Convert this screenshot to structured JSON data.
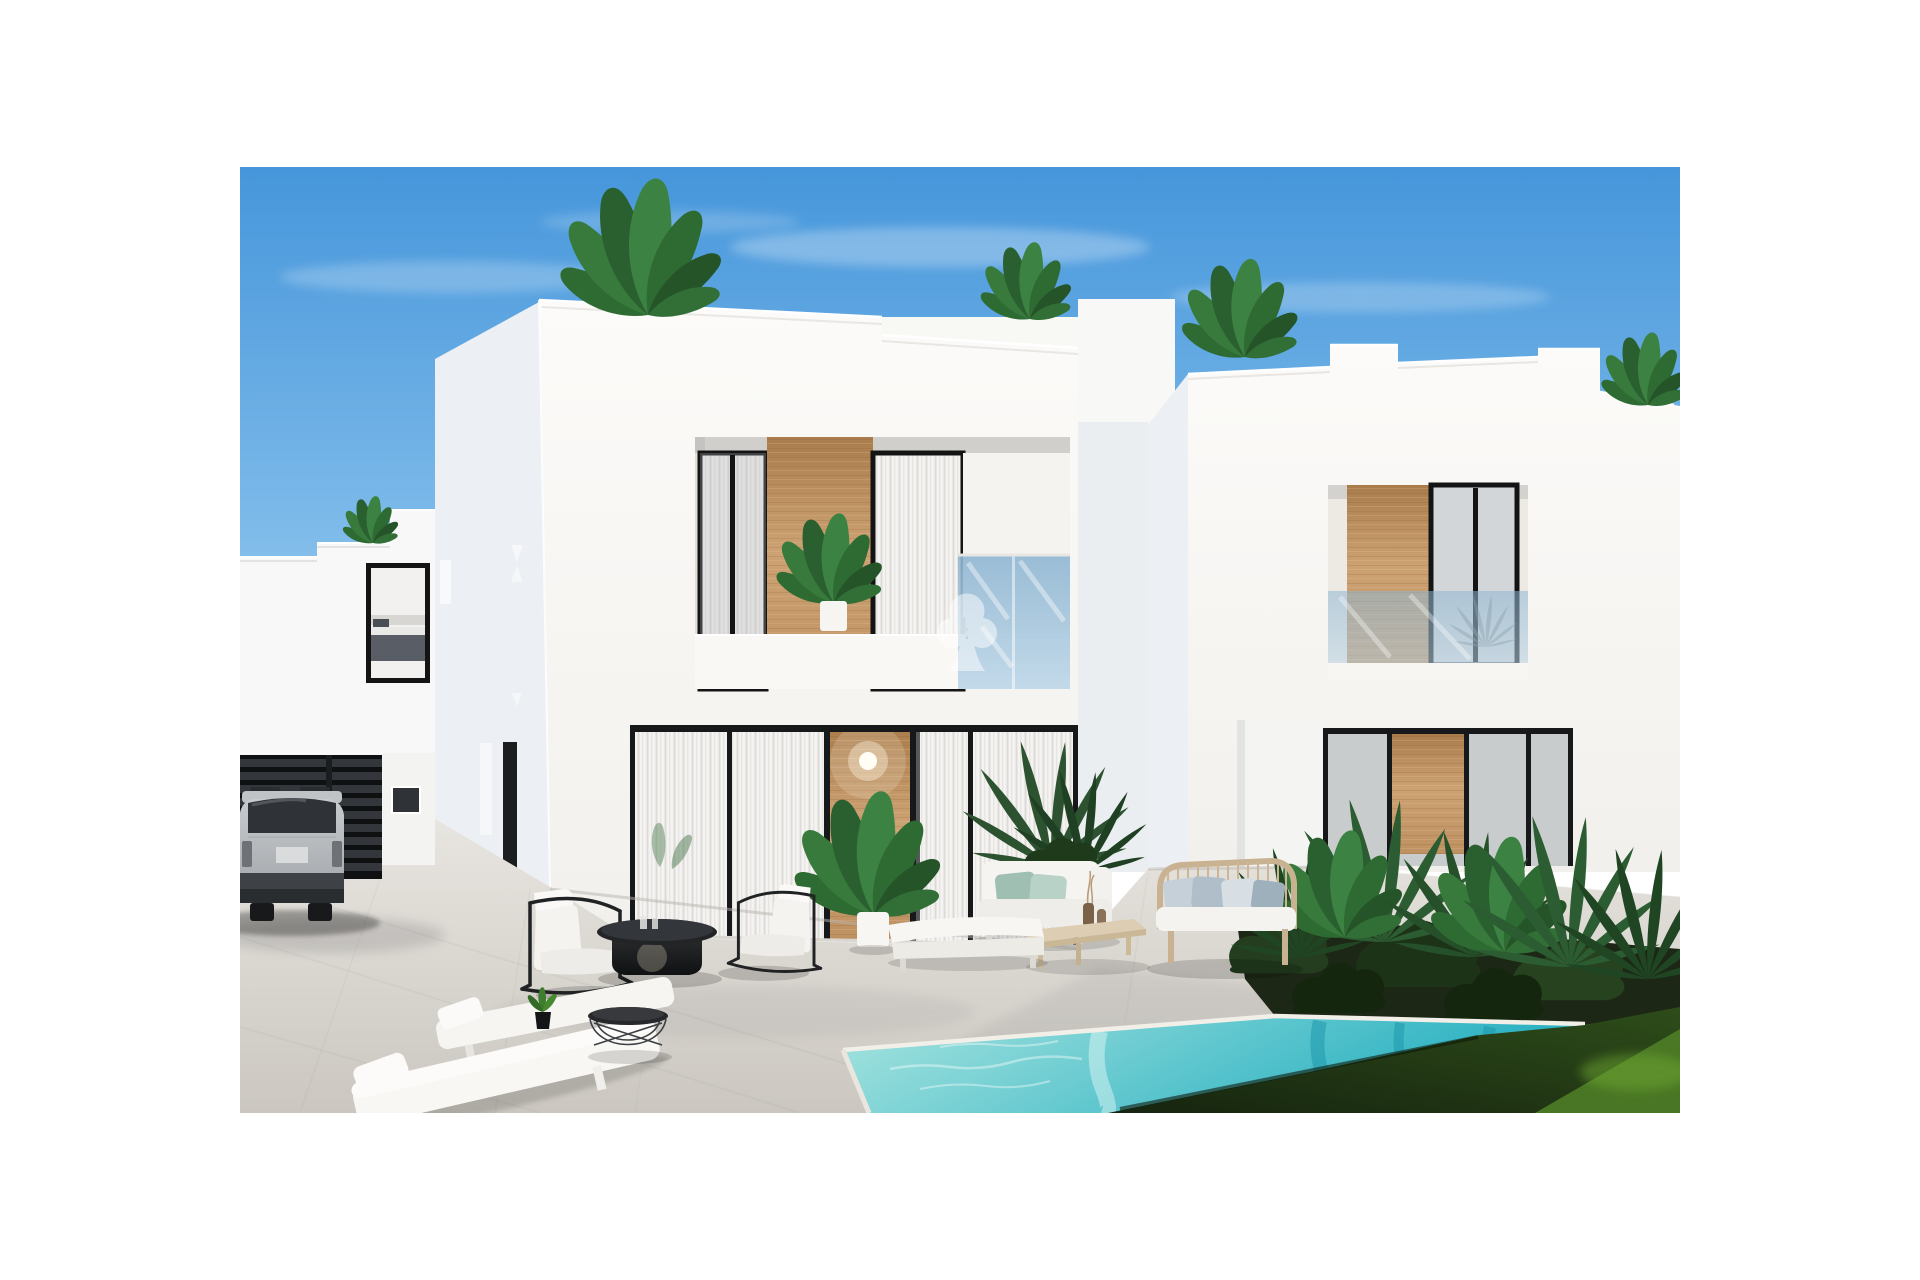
{
  "meta": {
    "type": "architectural-exterior-render",
    "subject": "New-build modern white two-storey villas with private pool, sun terrace, lounge furniture, parked SUV and tropical landscaping under a clear blue sky",
    "framing": "photograph centered on white page with wide white margins"
  },
  "watermark": {
    "name": "agency-logo-watermark",
    "shape": "three-lobed tree / clover crown with flared trunk",
    "color": "#FFFFFF",
    "opacity": 0.5
  },
  "palette": {
    "sky_top": "#4696DB",
    "sky_mid": "#7BB9E9",
    "sky_horizon": "#C9E2F6",
    "wall_sunlit": "#FCFBF9",
    "wall_sunlit_dim": "#F2F0EC",
    "wall_shadow": "#ECEFF3",
    "wall_far": "#EBEEF1",
    "frame_dark": "#17181A",
    "wood_light": "#CDA273",
    "wood_mid": "#BE9161",
    "wood_dark": "#A97C4C",
    "curtain_light": "#F4F3F1",
    "curtain_stripe": "#DDDBD7",
    "balcony_glass": "#8FB6D2",
    "balcony_glass_light": "#BCD6E8",
    "patio_light": "#E8E5E0",
    "patio_dark": "#CBC7C0",
    "pool_light": "#A7E4DF",
    "pool_deep": "#23AEC0",
    "coping": "#F2EFE8",
    "grass_dark": "#16240F",
    "grass_mid": "#2E4D1A",
    "grass_light": "#4E7D26",
    "foliage": "#2E6B33",
    "foliage_dark": "#1F4523",
    "soil": "#1D2716",
    "rattan": "#C9B291",
    "cushion_white": "#F4F3F0",
    "pillow_sage": "#9FBFB2",
    "pillow_blue": "#AFBEC9",
    "car_silver": "#C8CBCE",
    "car_window": "#2F3337",
    "table_black": "#222426"
  },
  "scene": {
    "sky": "clear blue sky with thin cirrus clouds",
    "buildings": [
      "rear villa far left with bedroom window",
      "main central villa with recessed balcony, wood feature panels and curtained glass walls",
      "right villa with stepped parapet, wood feature panels and garden wall"
    ],
    "rooftop_plants": 5,
    "pool": "turquoise private pool with pale stone coping, lawn beyond",
    "vehicle": "silver SUV parked by dark slatted gate",
    "furniture": [
      "two black-frame armchairs with white cushions",
      "round black pedestal coffee table",
      "two white sun loungers",
      "wire side table",
      "white backless chaise",
      "white daybed with sage pillows",
      "light wood coffee table with vases",
      "rattan two-seat sofa with blue-grey pillows"
    ]
  }
}
